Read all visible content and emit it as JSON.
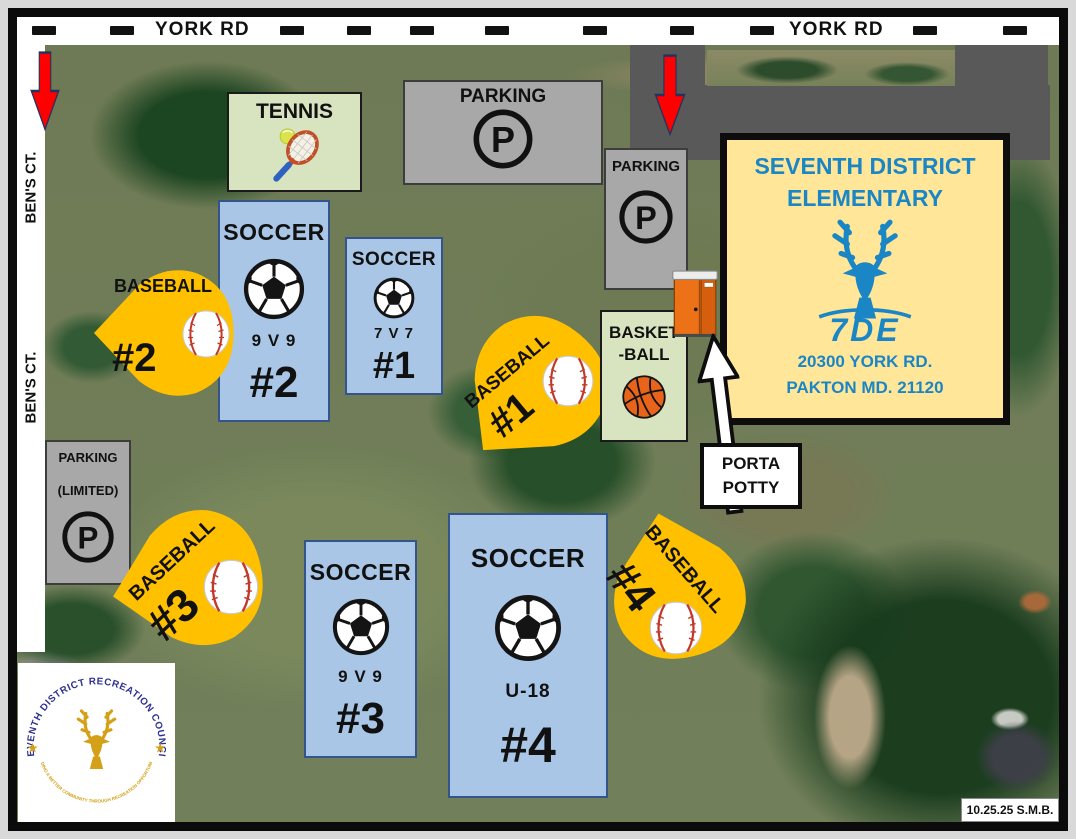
{
  "roads": {
    "york_rd_label_left": "YORK RD",
    "york_rd_label_right": "YORK RD",
    "bens_ct_label_upper": "BEN'S CT.",
    "bens_ct_label_lower": "BEN'S CT."
  },
  "school": {
    "title_line1": "SEVENTH DISTRICT",
    "title_line2": "ELEMENTARY",
    "logo_text": "7DE",
    "address_line1": "20300 YORK RD.",
    "address_line2": "PAKTON MD. 21120"
  },
  "facilities": {
    "tennis_label": "TENNIS",
    "parking_top_label": "PARKING",
    "parking_school_label": "PARKING",
    "parking_limited_label": "PARKING",
    "parking_limited_sublabel": "(LIMITED)",
    "parking_symbol": "P",
    "basketball_label_line1": "BASKET",
    "basketball_label_line2": "-BALL",
    "porta_potty_line1": "PORTA",
    "porta_potty_line2": "POTTY"
  },
  "soccer_fields": [
    {
      "title": "SOCCER",
      "format": "7 V 7",
      "number": "#1"
    },
    {
      "title": "SOCCER",
      "format": "9 V 9",
      "number": "#2"
    },
    {
      "title": "SOCCER",
      "format": "9 V 9",
      "number": "#3"
    },
    {
      "title": "SOCCER",
      "format": "U-18",
      "number": "#4"
    }
  ],
  "baseball_fields": [
    {
      "title": "BASEBALL",
      "number": "#1"
    },
    {
      "title": "BASEBALL",
      "number": "#2"
    },
    {
      "title": "BASEBALL",
      "number": "#3"
    },
    {
      "title": "BASEBALL",
      "number": "#4"
    }
  ],
  "council_logo": {
    "arc_top_text": "SEVENTH DISTRICT RECREATION COUNCIL",
    "arc_bottom_text": "\"BUILDING A BETTER COMMUNITY THROUGH RECREATION OPPORTUNITIES\"",
    "star": "★"
  },
  "footer": {
    "date_stamp": "10.25.25 S.M.B."
  },
  "colors": {
    "soccer_field_fill": "#A9C6E6",
    "baseball_field_fill": "#FFC000",
    "school_fill": "#FFE699",
    "school_text": "#1B86C5",
    "parking_fill": "#A8A8A8",
    "court_fill": "#D8E4C0",
    "driveway_fill": "#595959",
    "entrance_arrow": "#FF0000"
  }
}
